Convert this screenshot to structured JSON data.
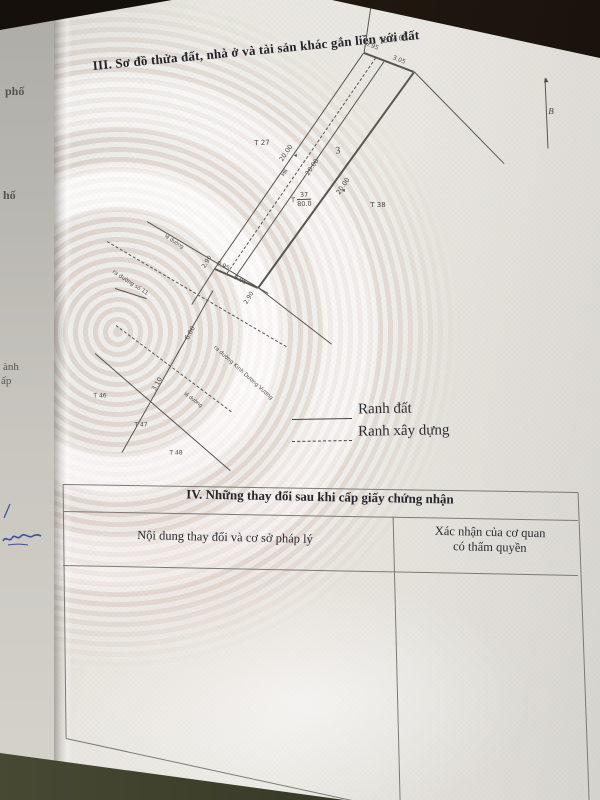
{
  "doc": {
    "section3_title": "III. Sơ đồ thửa đất, nhà ở và tài sản khác gắn liền với đất",
    "section4": {
      "title": "IV. Những thay đổi sau khi cấp giấy chứng nhận",
      "col1_header": "Nội dung thay đổi và cơ sở pháp lý",
      "col2_header_line1": "Xác nhận của cơ quan",
      "col2_header_line2": "có thẩm quyền"
    },
    "legend": {
      "solid": "Ranh đất",
      "dashed": "Ranh xây dựng"
    },
    "edge_fragments": {
      "f1": "phố",
      "f2": "hố",
      "f3": "ành",
      "f4": "ấp"
    }
  },
  "diagram": {
    "plot_label": {
      "prefix": "T",
      "numerator": "37",
      "denominator": "80.0"
    },
    "labels": [
      {
        "t": "Tờ số 68.",
        "x": 394,
        "y": 39,
        "r": -10,
        "s": 8,
        "f": "hand"
      },
      {
        "t": "0.95",
        "x": 372,
        "y": 46,
        "r": 22,
        "s": 6
      },
      {
        "t": "3.05",
        "x": 399,
        "y": 60,
        "r": 22,
        "s": 6
      },
      {
        "t": "T 27",
        "x": 262,
        "y": 143,
        "r": -2,
        "s": 7
      },
      {
        "t": "20.00",
        "x": 286,
        "y": 153,
        "r": -56,
        "s": 6.5
      },
      {
        "t": "20.00",
        "x": 312,
        "y": 167,
        "r": -56,
        "s": 6.5
      },
      {
        "t": "20.00",
        "x": 343,
        "y": 186,
        "r": -56,
        "s": 6.5
      },
      {
        "t": "M6",
        "x": 285,
        "y": 173,
        "r": -56,
        "s": 5
      },
      {
        "t": "3",
        "x": 338,
        "y": 151,
        "r": -15,
        "s": 10,
        "f": "hand"
      },
      {
        "t": "T 38",
        "x": 378,
        "y": 205,
        "r": 0,
        "s": 7
      },
      {
        "t": "0.95",
        "x": 223,
        "y": 266,
        "r": 26,
        "s": 6
      },
      {
        "t": "3.05",
        "x": 240,
        "y": 280,
        "r": 26,
        "s": 6
      },
      {
        "t": "2.90",
        "x": 207,
        "y": 262,
        "r": -58,
        "s": 6
      },
      {
        "t": "2.90",
        "x": 249,
        "y": 298,
        "r": -58,
        "s": 6
      },
      {
        "t": "lề đường",
        "x": 174,
        "y": 242,
        "r": 33,
        "s": 5
      },
      {
        "t": "ra đường số 11",
        "x": 130,
        "y": 283,
        "r": 33,
        "s": 5.5
      },
      {
        "t": "6.00",
        "x": 190,
        "y": 333,
        "r": -61,
        "s": 6.5
      },
      {
        "t": "3.10",
        "x": 157,
        "y": 384,
        "r": -61,
        "s": 6.5
      },
      {
        "t": "ra đường Kinh Dương Vương",
        "x": 243,
        "y": 373,
        "r": 42,
        "s": 5.5
      },
      {
        "t": "lề đường",
        "x": 193,
        "y": 400,
        "r": 37,
        "s": 5
      },
      {
        "t": "T 46",
        "x": 100,
        "y": 396,
        "r": 0,
        "s": 6
      },
      {
        "t": "T 47",
        "x": 141,
        "y": 425,
        "r": 0,
        "s": 6
      },
      {
        "t": "T 48",
        "x": 176,
        "y": 453,
        "r": 0,
        "s": 6
      },
      {
        "t": "▴",
        "x": 296,
        "y": 155,
        "r": 30,
        "s": 6
      },
      {
        "t": "▴",
        "x": 344,
        "y": 190,
        "r": 30,
        "s": 6
      },
      {
        "t": "B",
        "x": 551,
        "y": 111,
        "r": -2,
        "s": 9,
        "f": "hand"
      },
      {
        "t": "▲",
        "x": 546,
        "y": 80,
        "r": -3,
        "s": 6
      }
    ],
    "lines": [
      {
        "x1": 215,
        "y1": 268,
        "x2": 364,
        "y2": 52,
        "w": 1.4
      },
      {
        "x1": 258,
        "y1": 287,
        "x2": 414,
        "y2": 71,
        "w": 1.6
      },
      {
        "x1": 364,
        "y1": 52,
        "x2": 414,
        "y2": 71,
        "w": 1.6
      },
      {
        "x1": 215,
        "y1": 268,
        "x2": 258,
        "y2": 287,
        "w": 1.6
      },
      {
        "x1": 227,
        "y1": 273,
        "x2": 376,
        "y2": 57,
        "w": 1,
        "dash": true
      },
      {
        "x1": 235,
        "y1": 277,
        "x2": 384,
        "y2": 61,
        "w": 0.8
      },
      {
        "x1": 414,
        "y1": 71,
        "x2": 504,
        "y2": 163,
        "w": 0.8
      },
      {
        "x1": 364,
        "y1": 52,
        "x2": 371,
        "y2": 5,
        "w": 0.8
      },
      {
        "x1": 215,
        "y1": 268,
        "x2": 192,
        "y2": 304,
        "w": 0.8
      },
      {
        "x1": 258,
        "y1": 287,
        "x2": 332,
        "y2": 344,
        "w": 0.8
      },
      {
        "x1": 147,
        "y1": 221,
        "x2": 268,
        "y2": 293,
        "w": 1.2
      },
      {
        "x1": 107,
        "y1": 241,
        "x2": 286,
        "y2": 346,
        "w": 1,
        "dash": true
      },
      {
        "x1": 213,
        "y1": 290,
        "x2": 122,
        "y2": 452,
        "w": 1
      },
      {
        "x1": 116,
        "y1": 325,
        "x2": 231,
        "y2": 411,
        "w": 1,
        "dash": true
      },
      {
        "x1": 95,
        "y1": 353,
        "x2": 230,
        "y2": 470,
        "w": 1.2
      },
      {
        "x1": 115,
        "y1": 288,
        "x2": 146,
        "y2": 298,
        "w": 1
      },
      {
        "x1": 548,
        "y1": 148,
        "x2": 545,
        "y2": 78,
        "w": 1
      },
      {
        "x1": 292,
        "y1": 419,
        "x2": 352,
        "y2": 418,
        "w": 1.3,
        "c": "#45453f"
      },
      {
        "x1": 292,
        "y1": 441,
        "x2": 352,
        "y2": 440,
        "w": 1.3,
        "dash": true,
        "c": "#45453f"
      },
      {
        "x1": 63,
        "y1": 484,
        "x2": 578,
        "y2": 492,
        "w": 1.2,
        "c": "#7b7b74"
      },
      {
        "x1": 63,
        "y1": 511,
        "x2": 578,
        "y2": 520,
        "w": 1.2,
        "c": "#7b7b74"
      },
      {
        "x1": 63,
        "y1": 565,
        "x2": 578,
        "y2": 575,
        "w": 1.2,
        "c": "#7b7b74"
      },
      {
        "x1": 63,
        "y1": 484,
        "x2": 66,
        "y2": 738,
        "w": 1.2,
        "c": "#7b7b74"
      },
      {
        "x1": 578,
        "y1": 492,
        "x2": 589,
        "y2": 800,
        "w": 1.2,
        "c": "#7b7b74"
      },
      {
        "x1": 393,
        "y1": 516,
        "x2": 400,
        "y2": 800,
        "w": 1.2,
        "c": "#7b7b74"
      },
      {
        "x1": 66,
        "y1": 738,
        "x2": 352,
        "y2": 800,
        "w": 1.2,
        "c": "#7b7b74"
      }
    ]
  },
  "colors": {
    "paper": "#e9e7e1",
    "desk_dark": "#17110d",
    "desk_olive": "#3c3f2c",
    "diagram_line": "#57564f",
    "table_line": "#7b7b74",
    "ink": "#26262e",
    "signature_blue": "#3c4e9c",
    "guilloche_pink": "#c99e94"
  }
}
